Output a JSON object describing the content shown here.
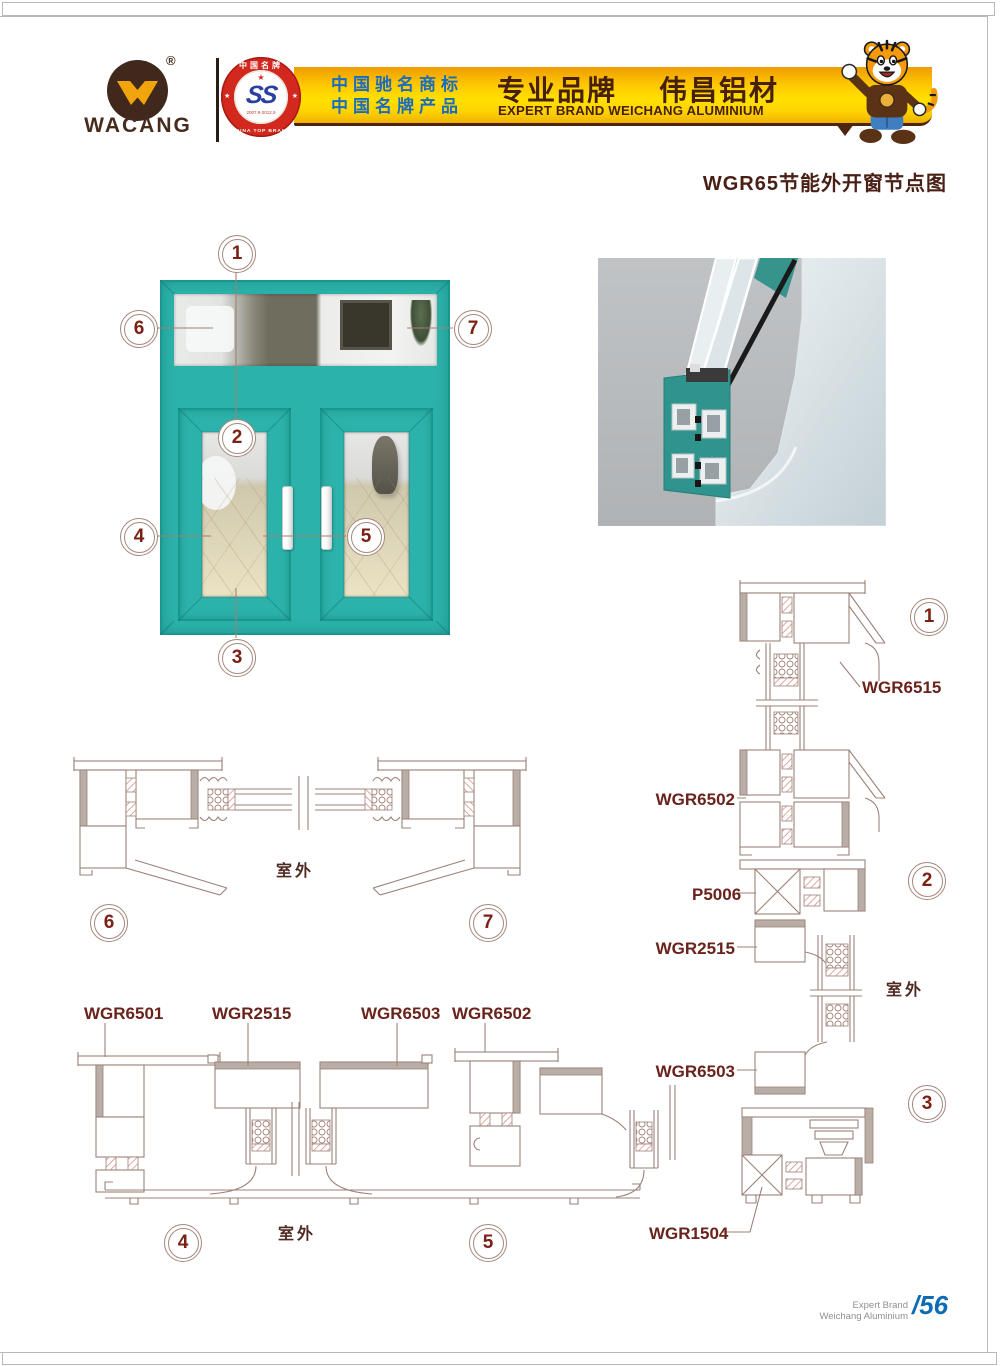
{
  "header": {
    "logo": {
      "brand": "WACANG",
      "registered": "®"
    },
    "badge": {
      "arc_top": "中国名牌",
      "monogram": "SS",
      "star": "★",
      "years": "2007.9-2012.9",
      "arc_bottom": "CHINA TOP BRAND",
      "star_left": "★",
      "star_right": "★"
    },
    "claims": {
      "line1": "中国驰名商标",
      "line2": "中国名牌产品"
    },
    "banner": {
      "title_left": "专业品牌",
      "title_right": "伟昌铝材",
      "subtitle": "EXPERT BRAND WEICHANG ALUMINIUM"
    }
  },
  "doc": {
    "title": "WGR65节能外开窗节点图"
  },
  "window": {
    "c1": "1",
    "c2": "2",
    "c3": "3",
    "c4": "4",
    "c5": "5",
    "c6": "6",
    "c7": "7"
  },
  "groupA": {
    "c6": "6",
    "c7": "7",
    "outdoor": "室外"
  },
  "groupB": {
    "l1": "WGR6501",
    "l2": "WGR2515",
    "l3": "WGR6503",
    "l4": "WGR6502",
    "c4": "4",
    "c5": "5",
    "outdoor": "室外"
  },
  "groupC": {
    "wgr6515": "WGR6515",
    "wgr6502": "WGR6502",
    "p5006": "P5006",
    "wgr2515": "WGR2515",
    "wgr6503": "WGR6503",
    "wgr1504": "WGR1504",
    "c1": "1",
    "c2": "2",
    "c3": "3",
    "outdoor": "室外"
  },
  "footer": {
    "line1": "Expert Brand",
    "line2": "Weichang Aluminium",
    "page": "/56"
  },
  "colors": {
    "teal": "#2bb3ab",
    "teal_dark": "#17978f",
    "banner_brown": "#46200a",
    "claims_blue": "#1a6cbe",
    "label_maroon": "#69231b",
    "drawing_line": "#9c8177",
    "hatch_pink": "#d6938b",
    "page_blue": "#0d6cb5",
    "title_brown": "#4a2016"
  }
}
